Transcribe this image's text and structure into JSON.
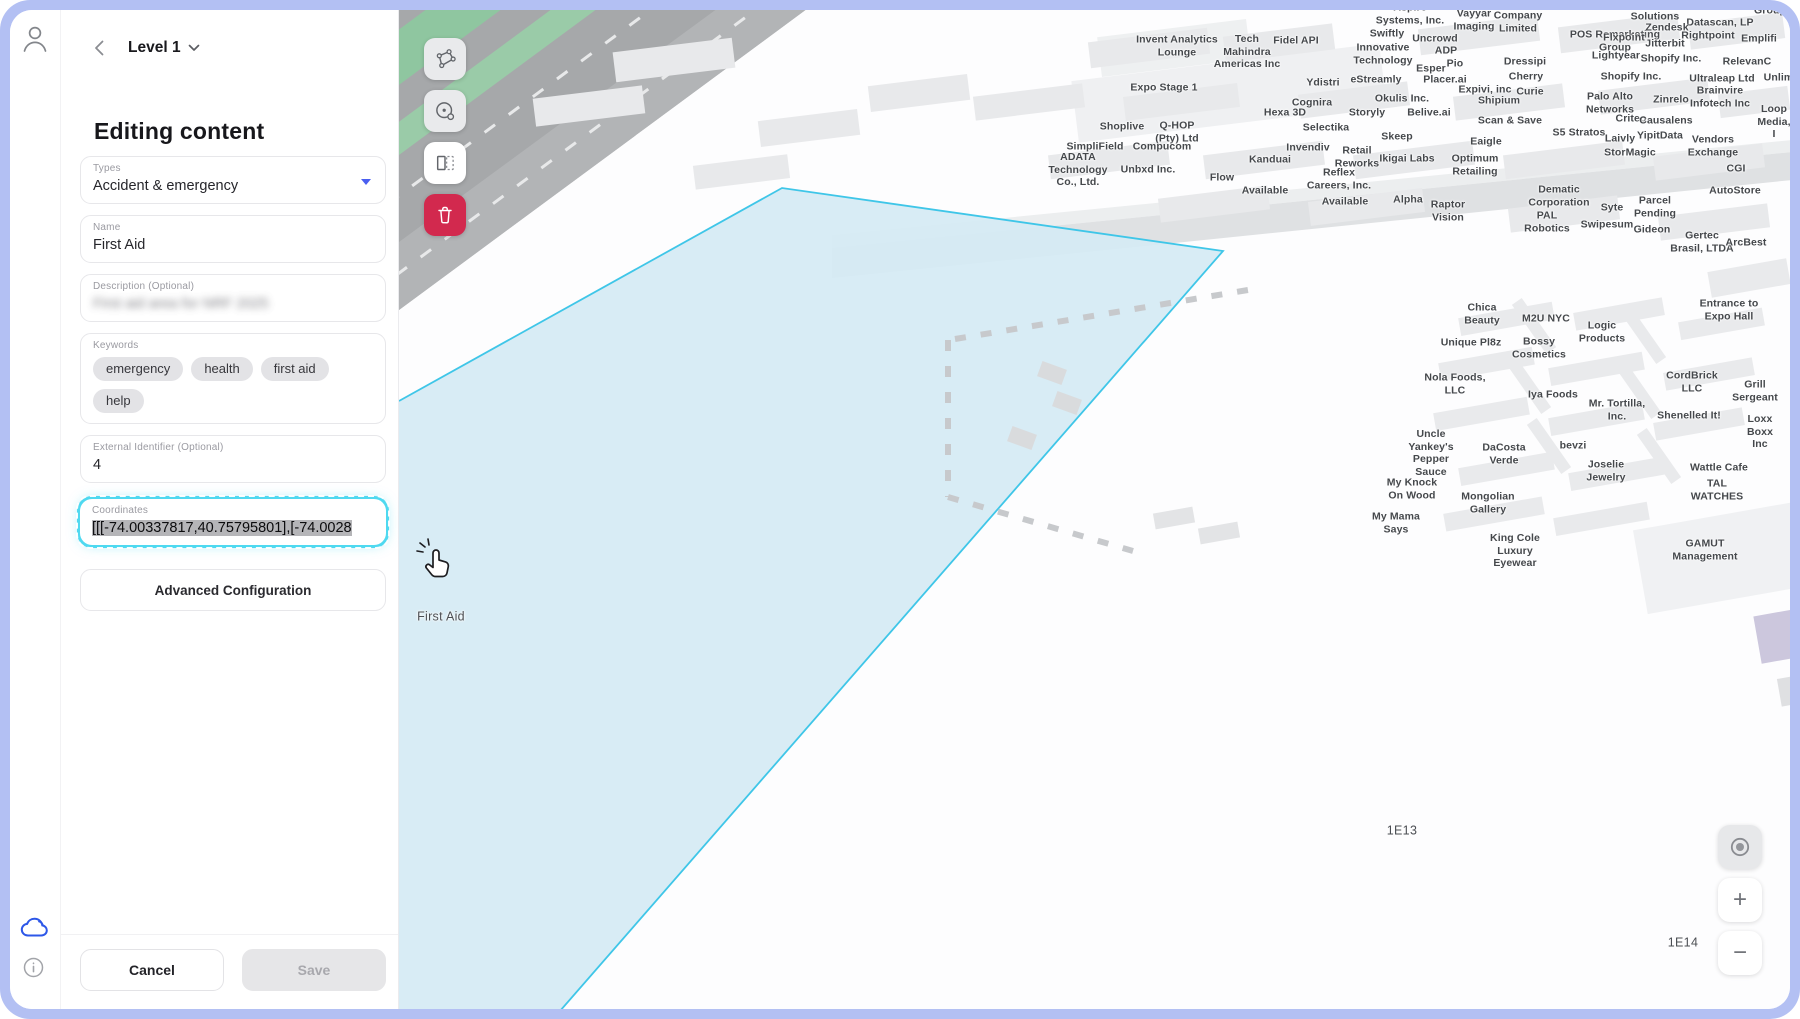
{
  "window": {
    "frame_color": "#b3c0f3"
  },
  "sidebar": {
    "level_label": "Level 1",
    "title": "Editing content",
    "fields": {
      "types": {
        "label": "Types",
        "value": "Accident & emergency"
      },
      "name": {
        "label": "Name",
        "value": "First Aid"
      },
      "description": {
        "label": "Description (Optional)",
        "value": "First aid area for NRF 2025"
      },
      "keywords": {
        "label": "Keywords",
        "chips": [
          "emergency",
          "health",
          "first aid",
          "help"
        ]
      },
      "external_id": {
        "label": "External Identifier (Optional)",
        "value": "4"
      },
      "coordinates": {
        "label": "Coordinates",
        "value": "[[[-74.00337817,40.75795801],[-74.0028"
      }
    },
    "advanced_button": "Advanced Configuration",
    "footer": {
      "cancel": "Cancel",
      "save": "Save"
    }
  },
  "map": {
    "controls": {
      "zoom_in": "+",
      "zoom_out": "−"
    },
    "selection_fill": "#d5eaf4",
    "selection_stroke": "#3fc6e8",
    "labels": [
      {
        "t": "First Aid",
        "x": 439,
        "y": 617,
        "big": true
      },
      {
        "t": "1E13",
        "x": 1400,
        "y": 831,
        "big": true
      },
      {
        "t": "1E14",
        "x": 1681,
        "y": 943,
        "big": true
      },
      {
        "t": "Expo Stage 1",
        "x": 1162,
        "y": 88
      },
      {
        "t": "Invent Analytics\nLounge",
        "x": 1175,
        "y": 46
      },
      {
        "t": "Tech\nMahindra\nAmericas Inc",
        "x": 1245,
        "y": 52
      },
      {
        "t": "Fidel API",
        "x": 1294,
        "y": 41
      },
      {
        "t": "Aspire\nSystems, Inc.",
        "x": 1408,
        "y": 14
      },
      {
        "t": "Vayyar\nImaging",
        "x": 1472,
        "y": 20
      },
      {
        "t": "Company\nLimited",
        "x": 1516,
        "y": 22
      },
      {
        "t": "Swiftly",
        "x": 1385,
        "y": 34
      },
      {
        "t": "Uncrowd",
        "x": 1433,
        "y": 39
      },
      {
        "t": "Innovative\nTechnology",
        "x": 1381,
        "y": 54
      },
      {
        "t": "ADP",
        "x": 1444,
        "y": 51
      },
      {
        "t": "POS Remarketing\nGroup",
        "x": 1613,
        "y": 41
      },
      {
        "t": "Esper",
        "x": 1429,
        "y": 69
      },
      {
        "t": "Pio",
        "x": 1453,
        "y": 64
      },
      {
        "t": "Dressipi",
        "x": 1523,
        "y": 62
      },
      {
        "t": "Ydistri",
        "x": 1321,
        "y": 83
      },
      {
        "t": "eStreamly",
        "x": 1374,
        "y": 80
      },
      {
        "t": "Placer.ai",
        "x": 1443,
        "y": 80
      },
      {
        "t": "Cherry",
        "x": 1524,
        "y": 77
      },
      {
        "t": "Expivi, inc",
        "x": 1483,
        "y": 90
      },
      {
        "t": "Curie",
        "x": 1528,
        "y": 92
      },
      {
        "t": "Cognira",
        "x": 1310,
        "y": 103
      },
      {
        "t": "Okulis Inc.",
        "x": 1400,
        "y": 99
      },
      {
        "t": "Shipium",
        "x": 1497,
        "y": 101
      },
      {
        "t": "Solutions",
        "x": 1653,
        "y": 17
      },
      {
        "t": "Datascan, LP",
        "x": 1718,
        "y": 23
      },
      {
        "t": "Group",
        "x": 1768,
        "y": 11
      },
      {
        "t": "Zendesk",
        "x": 1665,
        "y": 28
      },
      {
        "t": "Flxpoint",
        "x": 1622,
        "y": 38
      },
      {
        "t": "Rightpoint",
        "x": 1706,
        "y": 36
      },
      {
        "t": "Emplifi",
        "x": 1757,
        "y": 39
      },
      {
        "t": "Jitterbit",
        "x": 1663,
        "y": 44
      },
      {
        "t": "Lightyear",
        "x": 1614,
        "y": 56
      },
      {
        "t": "Shopify Inc.",
        "x": 1669,
        "y": 59
      },
      {
        "t": "RelevanC",
        "x": 1745,
        "y": 62
      },
      {
        "t": "Shopify Inc.",
        "x": 1629,
        "y": 77
      },
      {
        "t": "Ultraleap Ltd",
        "x": 1720,
        "y": 79
      },
      {
        "t": "Unlimi",
        "x": 1778,
        "y": 78
      },
      {
        "t": "Palo Alto\nNetworks",
        "x": 1608,
        "y": 103
      },
      {
        "t": "Zinrelo",
        "x": 1669,
        "y": 100
      },
      {
        "t": "Brainvire\nInfotech Inc",
        "x": 1718,
        "y": 97
      },
      {
        "t": "Criteo",
        "x": 1629,
        "y": 119
      },
      {
        "t": "Causalens",
        "x": 1664,
        "y": 121
      },
      {
        "t": "Loop\nMedia, I",
        "x": 1772,
        "y": 122
      },
      {
        "t": "S5 Stratos",
        "x": 1577,
        "y": 133
      },
      {
        "t": "Laivly",
        "x": 1618,
        "y": 139
      },
      {
        "t": "YipitData",
        "x": 1658,
        "y": 136
      },
      {
        "t": "StorMagic",
        "x": 1628,
        "y": 153
      },
      {
        "t": "Vendors\nExchange",
        "x": 1711,
        "y": 146
      },
      {
        "t": "CGI",
        "x": 1734,
        "y": 169
      },
      {
        "t": "AutoStore",
        "x": 1733,
        "y": 191
      },
      {
        "t": "Dematic\nCorporation",
        "x": 1557,
        "y": 196
      },
      {
        "t": "Syte",
        "x": 1610,
        "y": 208
      },
      {
        "t": "Parcel\nPending",
        "x": 1653,
        "y": 207
      },
      {
        "t": "PAL\nRobotics",
        "x": 1545,
        "y": 222
      },
      {
        "t": "Swipesum",
        "x": 1605,
        "y": 225
      },
      {
        "t": "Gideon",
        "x": 1650,
        "y": 230
      },
      {
        "t": "Gertec\nBrasil, LTDA",
        "x": 1700,
        "y": 242
      },
      {
        "t": "ArcBest",
        "x": 1744,
        "y": 243
      },
      {
        "t": "Hexa 3D",
        "x": 1283,
        "y": 113
      },
      {
        "t": "Storyly",
        "x": 1365,
        "y": 113
      },
      {
        "t": "Belive.ai",
        "x": 1427,
        "y": 113
      },
      {
        "t": "Scan & Save",
        "x": 1508,
        "y": 121
      },
      {
        "t": "Selectika",
        "x": 1324,
        "y": 128
      },
      {
        "t": "Skeep",
        "x": 1395,
        "y": 137
      },
      {
        "t": "Eaigle",
        "x": 1484,
        "y": 142
      },
      {
        "t": "Invendiv",
        "x": 1306,
        "y": 148
      },
      {
        "t": "Retail\nReworks",
        "x": 1355,
        "y": 157
      },
      {
        "t": "Ikigai Labs",
        "x": 1405,
        "y": 159
      },
      {
        "t": "Optimum\nRetailing",
        "x": 1473,
        "y": 165
      },
      {
        "t": "Reflex\nCareers, Inc.",
        "x": 1337,
        "y": 179
      },
      {
        "t": "Available",
        "x": 1343,
        "y": 202
      },
      {
        "t": "Alpha",
        "x": 1406,
        "y": 200
      },
      {
        "t": "Raptor\nVision",
        "x": 1446,
        "y": 211
      },
      {
        "t": "Shoplive",
        "x": 1120,
        "y": 127
      },
      {
        "t": "Q-HOP\n(Pty) Ltd",
        "x": 1175,
        "y": 132
      },
      {
        "t": "SimpliField",
        "x": 1093,
        "y": 147
      },
      {
        "t": "Compucom",
        "x": 1160,
        "y": 147
      },
      {
        "t": "ADATA\nTechnology\nCo., Ltd.",
        "x": 1076,
        "y": 170
      },
      {
        "t": "Unbxd Inc.",
        "x": 1146,
        "y": 170
      },
      {
        "t": "Flow",
        "x": 1220,
        "y": 178
      },
      {
        "t": "Kanduai",
        "x": 1268,
        "y": 160
      },
      {
        "t": "Available",
        "x": 1263,
        "y": 191
      },
      {
        "t": "Chica\nBeauty",
        "x": 1480,
        "y": 314
      },
      {
        "t": "M2U NYC",
        "x": 1544,
        "y": 319
      },
      {
        "t": "Logic\nProducts",
        "x": 1600,
        "y": 332
      },
      {
        "t": "Unique Pl8z",
        "x": 1469,
        "y": 343
      },
      {
        "t": "Bossy\nCosmetics",
        "x": 1537,
        "y": 348
      },
      {
        "t": "Nola Foods,\nLLC",
        "x": 1453,
        "y": 384
      },
      {
        "t": "Iya Foods",
        "x": 1551,
        "y": 395
      },
      {
        "t": "Mr. Tortilla,\nInc.",
        "x": 1615,
        "y": 410
      },
      {
        "t": "Entrance to\nExpo Hall",
        "x": 1727,
        "y": 310
      },
      {
        "t": "CordBrick\nLLC",
        "x": 1690,
        "y": 382
      },
      {
        "t": "Grill\nSergeant",
        "x": 1753,
        "y": 391
      },
      {
        "t": "Shenelled It!",
        "x": 1687,
        "y": 416
      },
      {
        "t": "Loxx\nBoxx Inc",
        "x": 1758,
        "y": 432
      },
      {
        "t": "Wattle Cafe",
        "x": 1717,
        "y": 468
      },
      {
        "t": "TAL\nWATCHES",
        "x": 1715,
        "y": 490
      },
      {
        "t": "GAMUT\nManagement",
        "x": 1703,
        "y": 550
      },
      {
        "t": "Uncle\nYankey's\nPepper\nSauce",
        "x": 1429,
        "y": 453
      },
      {
        "t": "DaCosta\nVerde",
        "x": 1502,
        "y": 454
      },
      {
        "t": "bevzi",
        "x": 1571,
        "y": 446
      },
      {
        "t": "Joselie\nJewelry",
        "x": 1604,
        "y": 471
      },
      {
        "t": "My Knock\nOn Wood",
        "x": 1410,
        "y": 489
      },
      {
        "t": "Mongolian\nGallery",
        "x": 1486,
        "y": 503
      },
      {
        "t": "My Mama\nSays",
        "x": 1394,
        "y": 523
      },
      {
        "t": "King Cole\nLuxury\nEyewear",
        "x": 1513,
        "y": 551
      }
    ]
  }
}
